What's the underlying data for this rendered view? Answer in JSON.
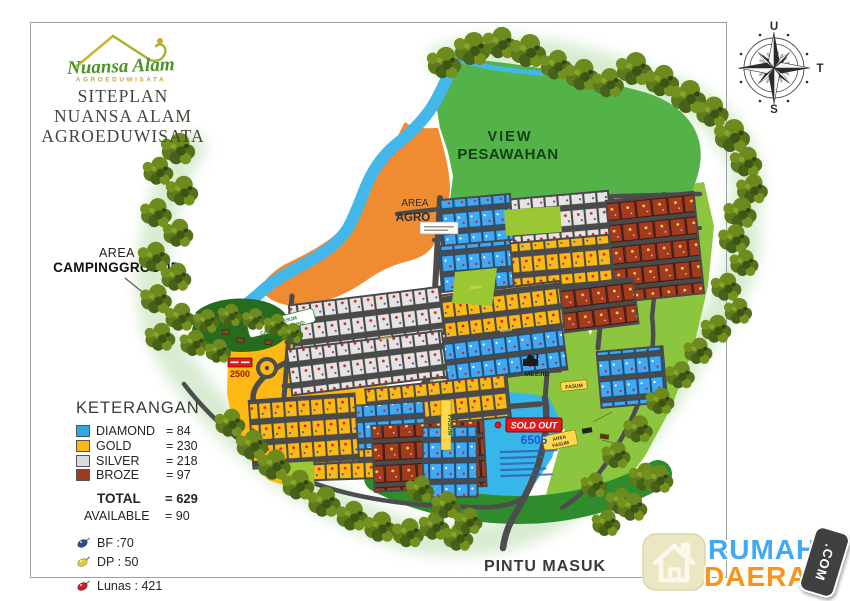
{
  "header": {
    "logo": {
      "brand": "Nuansa Alam",
      "brand_sub": "AGROEDUWISATA"
    },
    "title_line1": "SITEPLAN",
    "title_line2": "NUANSA ALAM",
    "title_line3": "AGROEDUWISATA"
  },
  "compass": {
    "north": "U",
    "east": "T",
    "south": "S"
  },
  "map": {
    "view_line1": "VIEW",
    "view_line2": "PESAWAHAN",
    "agro_line1": "AREA",
    "agro_line2": "AGRO",
    "camping_line1": "AREA",
    "camping_line2": "CAMPINGGROUND",
    "mesjid": "MESJID",
    "fasum_small": "FASUM",
    "fasum_vertical": "FASUM",
    "area_fasum_line1": "AREA",
    "area_fasum_line2": "FASUM",
    "fasum_camp_line1": "AREA FASUM",
    "fasum_camp_line2": "CAMPINGGROUND",
    "sold_out": "SOLD OUT",
    "sold_out_code": "6505",
    "badge_2500": "2500",
    "pintu_masuk": "PINTU MASUK"
  },
  "legend": {
    "title": "KETERANGAN",
    "items": [
      {
        "label": "DIAMOND",
        "value": "= 84",
        "color": "#2FA9E1"
      },
      {
        "label": "GOLD",
        "value": "= 230",
        "color": "#FDB913"
      },
      {
        "label": "SILVER",
        "value": "= 218",
        "color": "#DCDCDC"
      },
      {
        "label": "BROZE",
        "value": "= 97",
        "color": "#9E3A1E"
      }
    ],
    "total_label": "TOTAL",
    "total_value": "= 629",
    "available_label": "AVAILABLE",
    "available_value": "= 90",
    "markers": [
      {
        "label": "BF :70",
        "color": "#2A4D8F"
      },
      {
        "label": "DP : 50",
        "color": "#DFCD3E"
      },
      {
        "label": "Lunas : 421",
        "color": "#CE2127"
      }
    ]
  },
  "watermark": {
    "word1": "RUMAH",
    "word2": "DAERAH",
    "badge": ".COM"
  }
}
